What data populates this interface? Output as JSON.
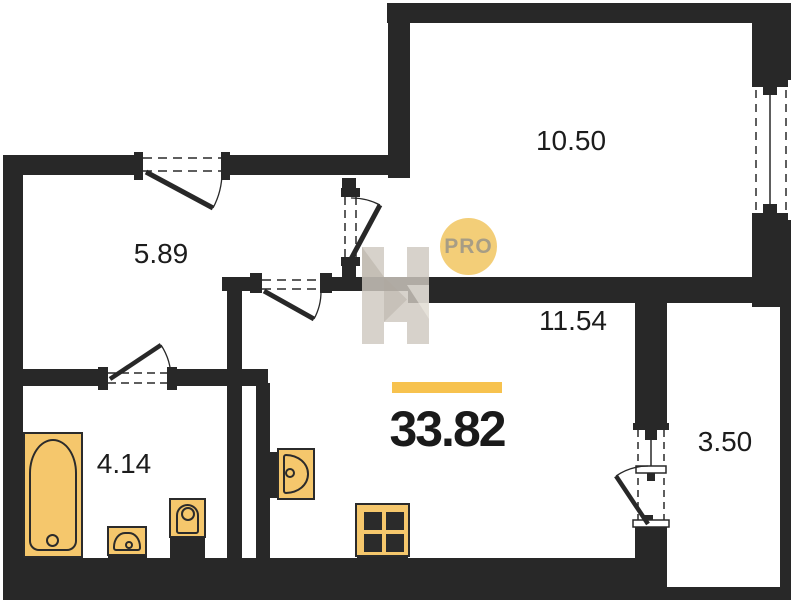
{
  "plan": {
    "type": "apartment-floor-plan",
    "total_area": "33.82",
    "rooms": [
      {
        "id": "room-top",
        "label": "10.50"
      },
      {
        "id": "hallway",
        "label": "5.89"
      },
      {
        "id": "living-kitchen",
        "label": "11.54"
      },
      {
        "id": "bathroom",
        "label": "4.14"
      },
      {
        "id": "balcony",
        "label": "3.50"
      }
    ],
    "watermark": {
      "logo_text": "PRO"
    },
    "fixtures": [
      {
        "name": "bathtub"
      },
      {
        "name": "washbasin"
      },
      {
        "name": "toilet"
      },
      {
        "name": "kitchen-sink"
      },
      {
        "name": "stove"
      }
    ],
    "colors": {
      "wall": "#282828",
      "fixture_fill": "#f5c76c",
      "fixture_border": "#2b2b2b",
      "accent_bar": "#f7c24e",
      "logo_circle": "#f3ce78",
      "logo_text": "#a79d85",
      "watermark_grey": "#cec8bf"
    }
  }
}
